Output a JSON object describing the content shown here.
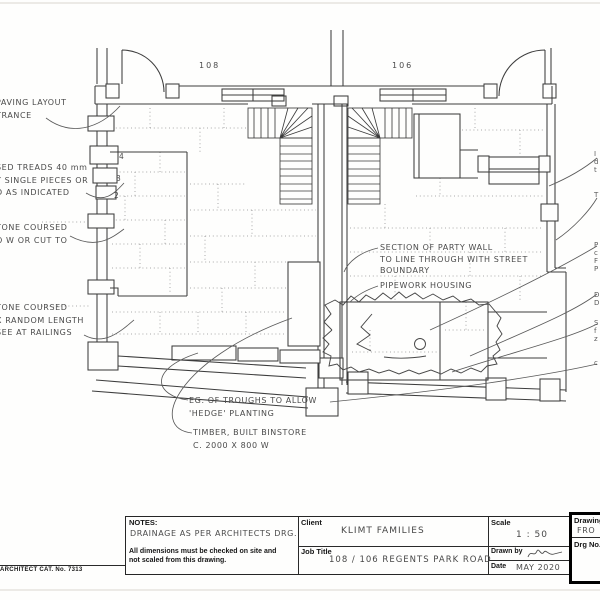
{
  "plan": {
    "house_number_left": "108",
    "house_number_right": "106",
    "step_numbers": [
      "4",
      "3",
      "2"
    ],
    "annotations": {
      "paving": {
        "lines": [
          "PAVING LAYOUT",
          "TRANCE"
        ]
      },
      "treads": {
        "lines": [
          "SED TREADS 40 mm",
          "Y SINGLE PIECES OR",
          "D AS INDICATED"
        ]
      },
      "stone_upper": {
        "lines": [
          "TONE COURSED",
          "O W OR CUT TO"
        ]
      },
      "stone_lower": {
        "lines": [
          "TONE COURSED",
          "X RANDOM LENGTH",
          "SEE AT RAILINGS"
        ]
      },
      "party_wall": {
        "lines": [
          "SECTION OF PARTY WALL",
          "TO LINE THROUGH WITH STREET",
          "BOUNDARY"
        ]
      },
      "pipework": {
        "lines": [
          "PIPEWORK HOUSING"
        ]
      },
      "troughs": {
        "lines": [
          "EG. OF TROUGHS TO ALLOW",
          "'HEDGE' PLANTING"
        ]
      },
      "binstore": {
        "lines": [
          "TIMBER, BUILT BINSTORE",
          "C. 2000 X 800 W"
        ]
      },
      "right_edge_fragments": [
        "I",
        "d",
        "t",
        "T",
        "P",
        "c",
        "F",
        "P",
        "D",
        "D",
        "S",
        "f",
        "z",
        "c"
      ]
    }
  },
  "title_block": {
    "notes": {
      "label": "NOTES:",
      "handwritten": "DRAINAGE AS PER ARCHITECTS DRG.",
      "printed_line1": "All dimensions must be checked on site and",
      "printed_line2": "not scaled from this drawing."
    },
    "client": {
      "label": "Client",
      "value": "KLIMT FAMILIES"
    },
    "job_title": {
      "label": "Job Title",
      "value": "108 / 106 REGENTS PARK ROAD"
    },
    "scale": {
      "label": "Scale",
      "value": "1 : 50"
    },
    "drawn_by": {
      "label": "Drawn by"
    },
    "date": {
      "label": "Date",
      "value": "MAY 2020"
    },
    "drawing": {
      "label": "Drawing",
      "value": "FRO"
    },
    "drg_no": {
      "label": "Drg No."
    }
  },
  "footer": {
    "catalog_text": "- ARCHITECT CAT. No. 7313"
  },
  "colors": {
    "ink": "#3d3d3d",
    "paper": "#fefefd"
  }
}
